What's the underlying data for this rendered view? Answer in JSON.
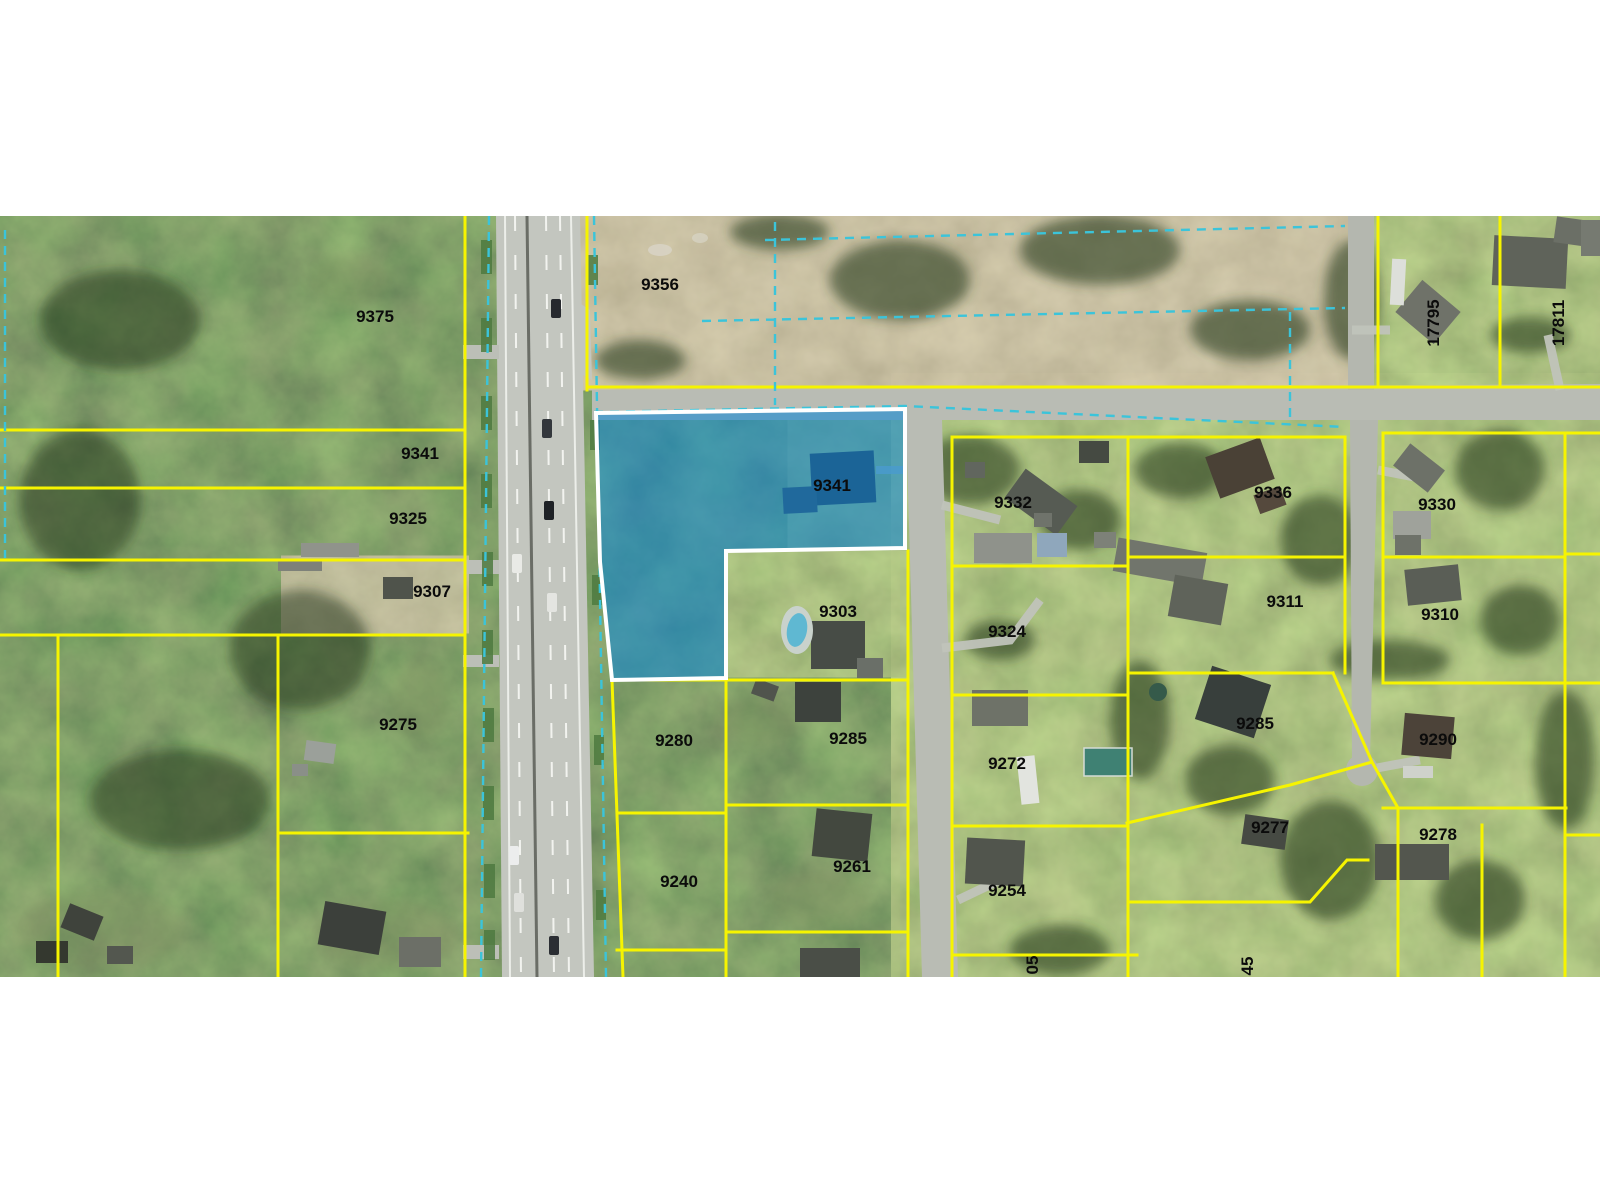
{
  "map": {
    "description": "Aerial photo parcel map with subject property highlighted in blue",
    "colors": {
      "parcel_line": "#f6f400",
      "overlay_dash": "#3bc4da",
      "highlight_fill": "#0e86d6",
      "highlight_border": "#ffffff",
      "label": "#0b0b0b",
      "page_background": "#ffffff"
    },
    "subject_parcel_number": "9341"
  },
  "labels": [
    "9375",
    "9341",
    "9325",
    "9307",
    "9275",
    "9356",
    "9341",
    "9303",
    "9332",
    "9336",
    "9324",
    "9311",
    "9330",
    "9310",
    "9280",
    "9285",
    "9240",
    "9261",
    "9272",
    "9285",
    "9277",
    "9254",
    "9290",
    "9278",
    "17795",
    "17811",
    "05",
    "45"
  ]
}
